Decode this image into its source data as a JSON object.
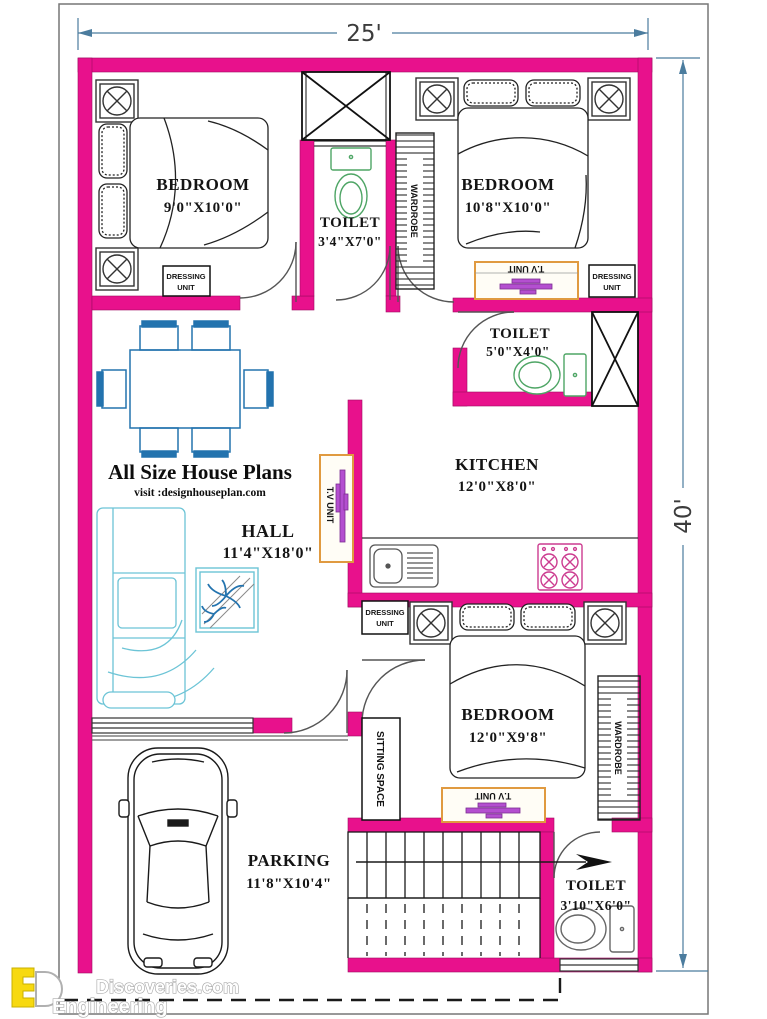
{
  "dimensions": {
    "width": "25'",
    "height": "40'"
  },
  "rooms": {
    "bedroom1": {
      "name": "BEDROOM",
      "size": "9'0\"X10'0\""
    },
    "toilet1": {
      "name": "TOILET",
      "size": "3'4\"X7'0\""
    },
    "bedroom2": {
      "name": "BEDROOM",
      "size": "10'8\"X10'0\""
    },
    "toilet2": {
      "name": "TOILET",
      "size": "5'0\"X4'0\""
    },
    "kitchen": {
      "name": "KITCHEN",
      "size": "12'0\"X8'0\""
    },
    "hall": {
      "name": "HALL",
      "size": "11'4\"X18'0\""
    },
    "bedroom3": {
      "name": "BEDROOM",
      "size": "12'0\"X9'8\""
    },
    "toilet3": {
      "name": "TOILET",
      "size": "3'10\"X6'0\""
    },
    "parking": {
      "name": "PARKING",
      "size": "11'8\"X10'4\""
    }
  },
  "furniture_labels": {
    "dressing_line1": "DRESSING",
    "dressing_line2": "UNIT",
    "tv_unit": "T.V UNIT",
    "wardrobe": "WARDROBE",
    "sitting_space": "SITTING SPACE"
  },
  "branding": {
    "title": "All Size House Plans",
    "website": "visit :designhouseplan.com"
  },
  "watermark": {
    "site": "Discoveries.com",
    "word": "Engineering"
  },
  "colors": {
    "wall": "#e8118c",
    "dimension": "#4b7c9e",
    "furniture_blue": "#2373ae",
    "sofa_teal": "#6cc4d6",
    "fixture_green": "#4ea565",
    "fixture_gray": "#666666",
    "tv_orange": "#e09a40",
    "tv_purple": "#b44fd0",
    "stove_pink": "#cc3c90",
    "logo_yellow": "#f7d90f"
  }
}
